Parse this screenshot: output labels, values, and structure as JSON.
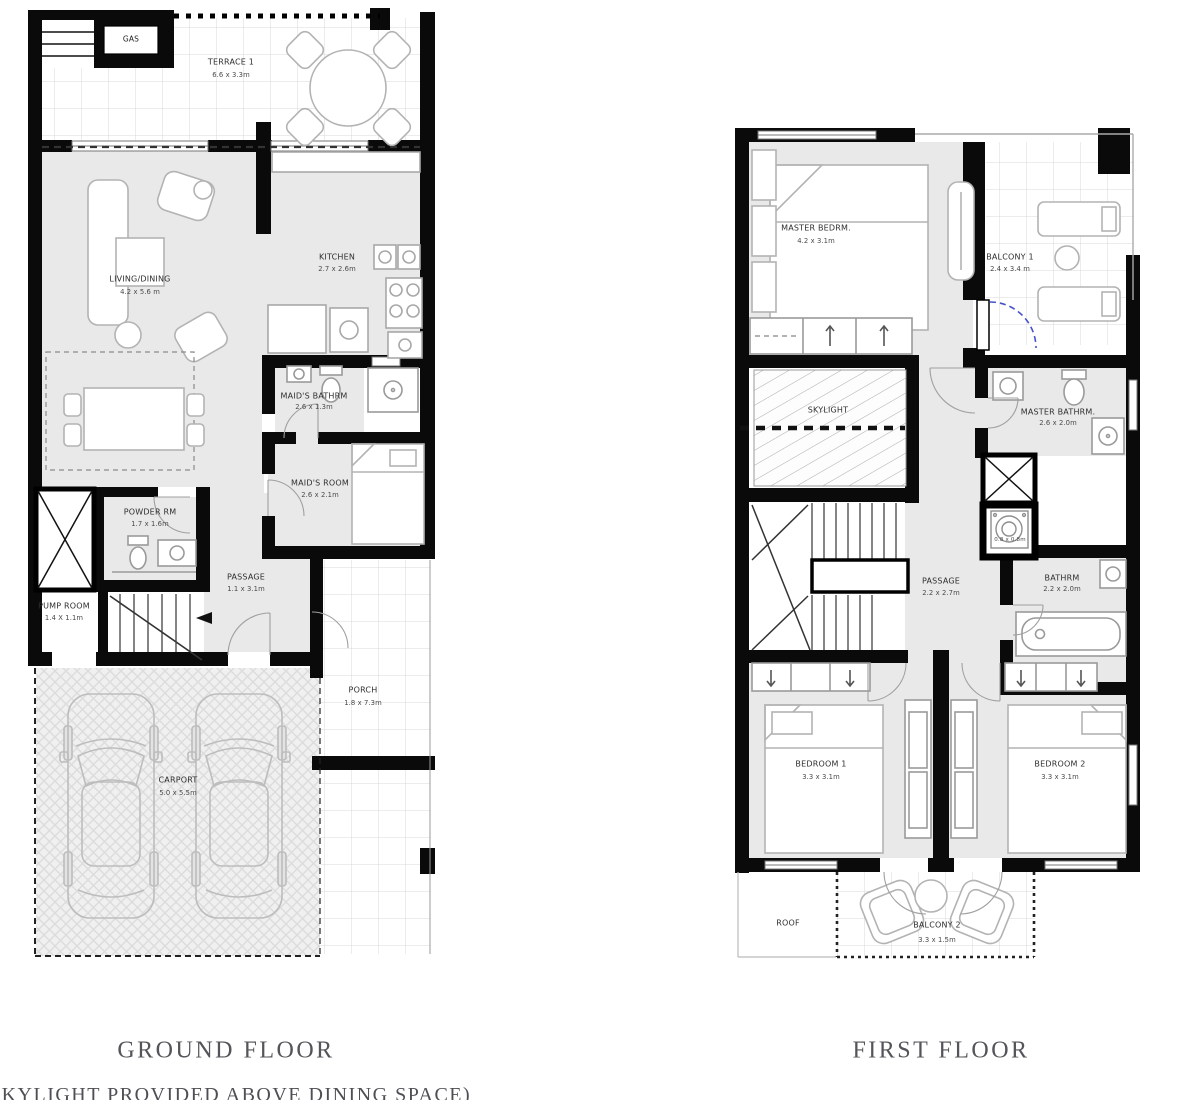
{
  "ground": {
    "title": "GROUND FLOOR",
    "note": "(SKYLIGHT PROVIDED ABOVE DINING SPACE)",
    "rooms": {
      "gas": {
        "name": "GAS"
      },
      "terrace": {
        "name": "TERRACE 1",
        "dims": "6.6 x 3.3m"
      },
      "living": {
        "name": "LIVING/DINING",
        "dims": "4.2 x 5.6 m"
      },
      "kitchen": {
        "name": "KITCHEN",
        "dims": "2.7 x 2.6m"
      },
      "maids_bath": {
        "name": "MAID'S BATHRM",
        "dims": "2.6 x 1.3m"
      },
      "maids_room": {
        "name": "MAID'S ROOM",
        "dims": "2.6 x 2.1m"
      },
      "powder": {
        "name": "POWDER RM",
        "dims": "1.7 x 1.6m"
      },
      "pump": {
        "name": "PUMP ROOM",
        "dims": "1.4 X 1.1m"
      },
      "passage": {
        "name": "PASSAGE",
        "dims": "1.1 x 3.1m"
      },
      "porch": {
        "name": "PORCH",
        "dims": "1.8 x 7.3m"
      },
      "carport": {
        "name": "CARPORT",
        "dims": "5.0 x 5.5m"
      }
    }
  },
  "first": {
    "title": "FIRST FLOOR",
    "rooms": {
      "master": {
        "name": "MASTER BEDRM.",
        "dims": "4.2 x 3.1m"
      },
      "balcony1": {
        "name": "BALCONY 1",
        "dims": "2.4 x 3.4 m"
      },
      "skylight": {
        "name": "SKYLIGHT"
      },
      "master_bath": {
        "name": "MASTER BATHRM.",
        "dims": "2.6 x 2.0m"
      },
      "passage": {
        "name": "PASSAGE",
        "dims": "2.2 x 2.7m"
      },
      "wm": {
        "dims": "0.8 x 0.8m"
      },
      "bathrm": {
        "name": "BATHRM",
        "dims": "2.2 x 2.0m"
      },
      "bedroom1": {
        "name": "BEDROOM 1",
        "dims": "3.3 x 3.1m"
      },
      "bedroom2": {
        "name": "BEDROOM 2",
        "dims": "3.3 x 3.1m"
      },
      "roof": {
        "name": "ROOF"
      },
      "balcony2": {
        "name": "BALCONY 2",
        "dims": "3.3 x 1.5m"
      }
    }
  },
  "colors": {
    "wall": "#0a0a0a",
    "floor": "#e9e9e9",
    "door_swing_accent": "#4553c8"
  }
}
